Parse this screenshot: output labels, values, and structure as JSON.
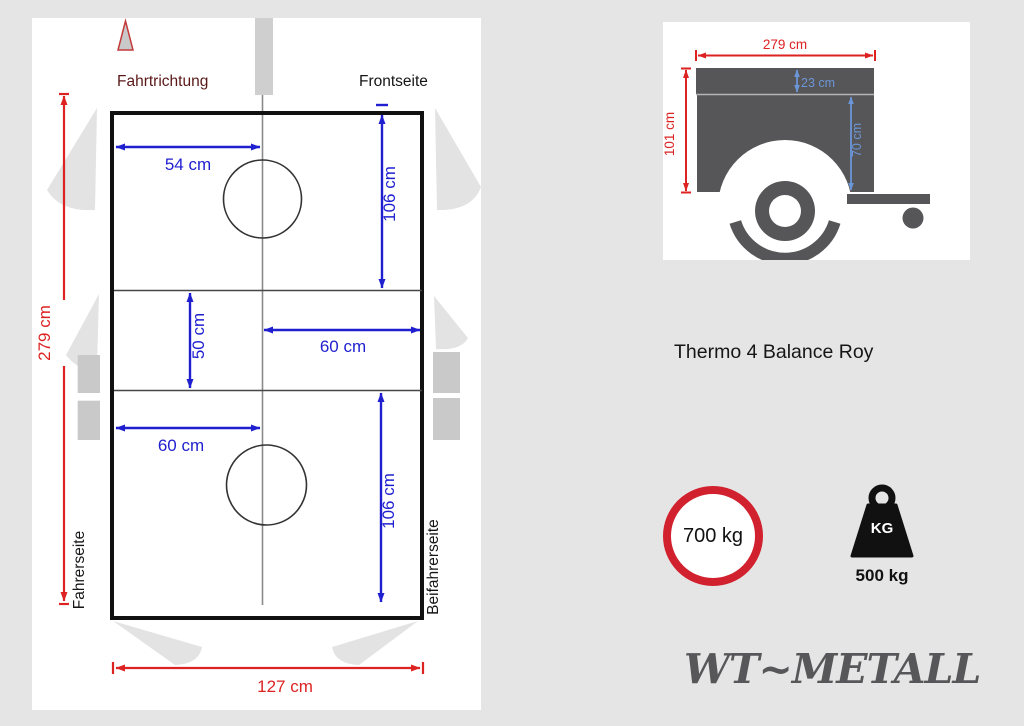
{
  "top_view": {
    "labels": {
      "direction": "Fahrtrichtung",
      "front": "Frontseite",
      "driver_side": "Fahrerseite",
      "passenger_side": "Beifahrerseite"
    },
    "dimensions": {
      "top_width": "54 cm",
      "front_depth": "106 cm",
      "partition_length": "50 cm",
      "mid_right_width": "60 cm",
      "mid_left_width": "60 cm",
      "rear_depth": "106 cm",
      "total_length": "279 cm",
      "total_width": "127 cm"
    },
    "colors": {
      "dimension_blue": "#1f1fd0",
      "dimension_red": "#dd2222",
      "direction_text": "#5a1818"
    }
  },
  "side_view": {
    "dimensions": {
      "length": "279 cm",
      "total_height": "101 cm",
      "lid_height": "23 cm",
      "body_height": "70 cm"
    },
    "colors": {
      "trailer_gray": "#565658",
      "dimension_red": "#dd2222",
      "dimension_blue": "#6b96d8"
    }
  },
  "product": {
    "name": "Thermo 4 Balance Roy"
  },
  "weights": {
    "total_weight": "700 kg",
    "kg_label": "KG",
    "payload": "500 kg",
    "sign_red": "#d2212e"
  },
  "brand": {
    "logo_text": "WT~METALL",
    "color": "#57575a"
  }
}
